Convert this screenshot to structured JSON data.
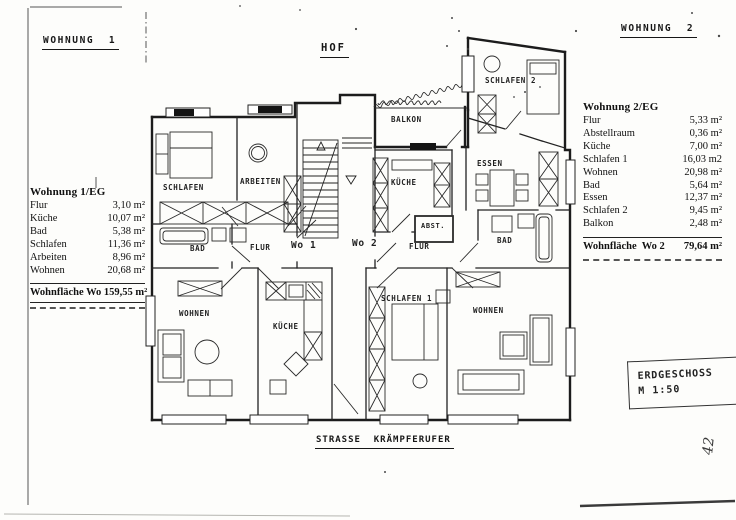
{
  "page": {
    "apartment1_heading": "WOHNUNG  1",
    "apartment2_heading": "WOHNUNG  2",
    "hof_label": "HOF",
    "street_label": "STRASSE  KRÄMPFERUFER",
    "title_block": {
      "floor": "ERDGESCHOSS",
      "scale": "M 1:50"
    },
    "handwritten_note": "42"
  },
  "area_table_1": {
    "title": "Wohnung 1/EG",
    "rows": [
      {
        "room": "Flur",
        "area": "3,10 m²"
      },
      {
        "room": "Küche",
        "area": "10,07 m²"
      },
      {
        "room": "Bad",
        "area": "5,38 m²"
      },
      {
        "room": "Schlafen",
        "area": "11,36 m²"
      },
      {
        "room": "Arbeiten",
        "area": "8,96 m²"
      },
      {
        "room": "Wohnen",
        "area": "20,68 m²"
      }
    ],
    "total_label": "Wohnfläche Wo 1",
    "total_area": "59,55 m²"
  },
  "area_table_2": {
    "title": "Wohnung 2/EG",
    "rows": [
      {
        "room": "Flur",
        "area": "5,33 m²"
      },
      {
        "room": "Abstellraum",
        "area": "0,36 m²"
      },
      {
        "room": "Küche",
        "area": "7,00 m²"
      },
      {
        "room": "Schlafen 1",
        "area": "16,03 m2"
      },
      {
        "room": "Wohnen",
        "area": "20,98 m²"
      },
      {
        "room": "Bad",
        "area": "5,64 m²"
      },
      {
        "room": "Essen",
        "area": "12,37 m²"
      },
      {
        "room": "Schlafen 2",
        "area": "9,45 m²"
      },
      {
        "room": "Balkon",
        "area": "2,48 m²"
      }
    ],
    "total_label": "Wohnfläche  Wo 2",
    "total_area": "79,64 m²"
  },
  "plan": {
    "labels": [
      {
        "id": "schlafen-wo1",
        "text": "SCHLAFEN",
        "x": 163,
        "y": 184,
        "fs": 7.5
      },
      {
        "id": "arbeiten-wo1",
        "text": "ARBEITEN",
        "x": 240,
        "y": 178,
        "fs": 7.5
      },
      {
        "id": "bad-wo1",
        "text": "BAD",
        "x": 190,
        "y": 245,
        "fs": 7.5
      },
      {
        "id": "flur-wo1",
        "text": "FLUR",
        "x": 250,
        "y": 244,
        "fs": 7.5
      },
      {
        "id": "wo1-door",
        "text": "Wo 1",
        "x": 291,
        "y": 241,
        "fs": 9.5
      },
      {
        "id": "wo2-door",
        "text": "Wo 2",
        "x": 352,
        "y": 239,
        "fs": 9.5
      },
      {
        "id": "kueche-wo2",
        "text": "KÜCHE",
        "x": 391,
        "y": 179,
        "fs": 7.5
      },
      {
        "id": "abst-wo2",
        "text": "ABST.",
        "x": 421,
        "y": 223,
        "fs": 7
      },
      {
        "id": "flur-wo2",
        "text": "FLUR",
        "x": 409,
        "y": 243,
        "fs": 7.5
      },
      {
        "id": "bad-wo2",
        "text": "BAD",
        "x": 497,
        "y": 237,
        "fs": 7.5
      },
      {
        "id": "essen-wo2",
        "text": "ESSEN",
        "x": 477,
        "y": 160,
        "fs": 7.5
      },
      {
        "id": "schlafen2-wo2",
        "text": "SCHLAFEN 2",
        "x": 485,
        "y": 77,
        "fs": 7.5
      },
      {
        "id": "balkon",
        "text": "BALKON",
        "x": 391,
        "y": 116,
        "fs": 7.5
      },
      {
        "id": "wohnen-wo1",
        "text": "WOHNEN",
        "x": 179,
        "y": 310,
        "fs": 7.5
      },
      {
        "id": "kueche-wo1",
        "text": "KÜCHE",
        "x": 273,
        "y": 323,
        "fs": 7.5
      },
      {
        "id": "schlafen1-wo2",
        "text": "SCHLAFEN 1",
        "x": 381,
        "y": 295,
        "fs": 7.5
      },
      {
        "id": "wohnen-wo2",
        "text": "WOHNEN",
        "x": 473,
        "y": 307,
        "fs": 7.5
      }
    ]
  }
}
